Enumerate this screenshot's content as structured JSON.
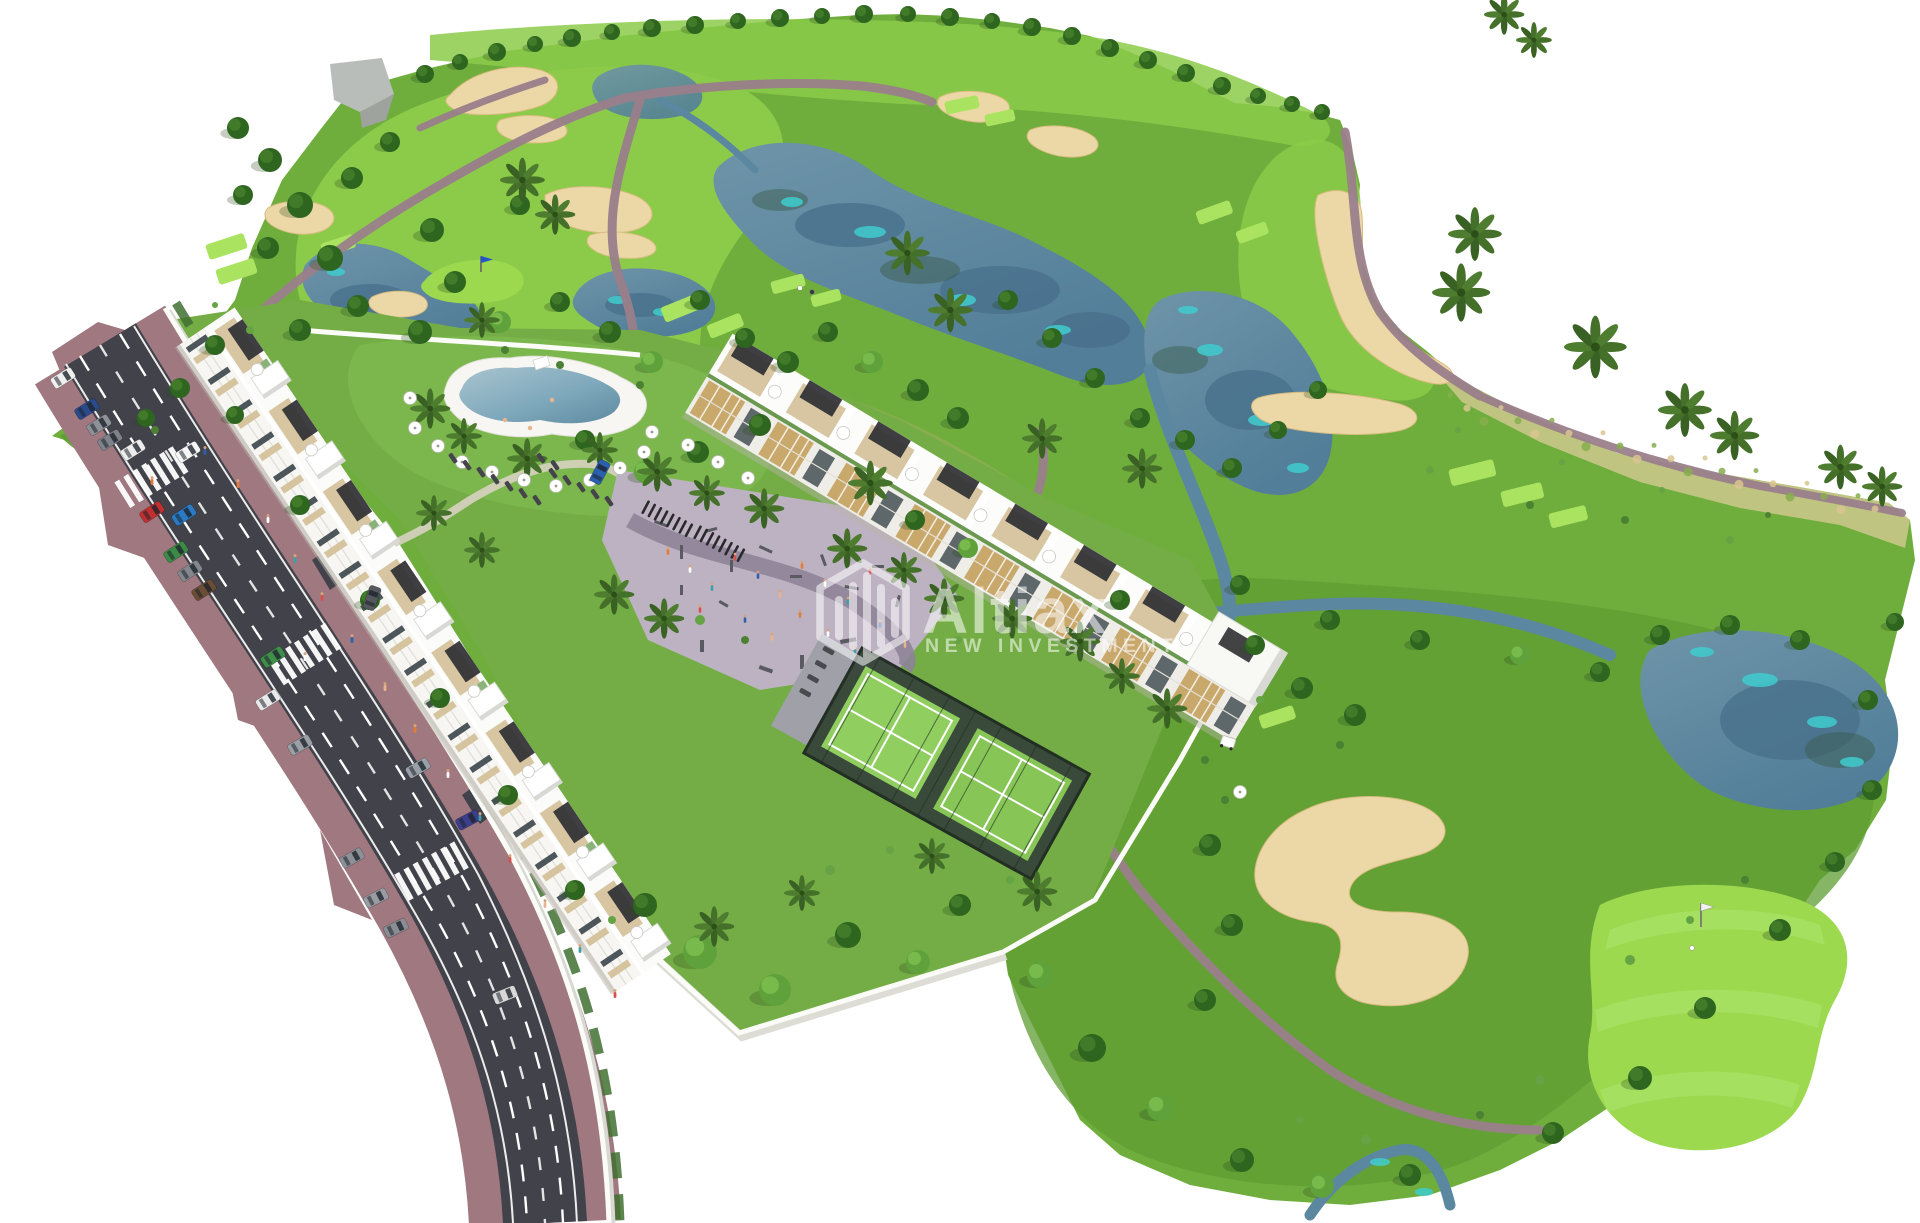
{
  "watermark": {
    "brand": "Altiax",
    "tagline": "NEW INVESTMENT",
    "logo_icon": "hexagon-bar-chart-icon",
    "color": "#FFFFFF",
    "opacity": 0.55
  },
  "scene": {
    "type": "aerial-architectural-rendering",
    "features": [
      "golf-course",
      "lakes",
      "sand-bunkers",
      "cart-paths",
      "tee-boxes",
      "putting-green-with-flag",
      "golf-cart",
      "access-road",
      "parked-cars",
      "apartment-block-a",
      "apartment-block-b",
      "swimming-pool",
      "playground-plaza",
      "padel-court",
      "gardens",
      "perimeter-walls",
      "palm-trees"
    ]
  },
  "palette": {
    "background": "#FFFFFF",
    "golf_base": "#6FAE3D",
    "fairway_light": "#8CCB49",
    "rough_dark": "#5F9C33",
    "tee_bright": "#A9E35F",
    "green_putting": "#9CD94F",
    "dry_scrub": "#C8C687",
    "dry_meadow": "#9FAF5C",
    "water": "#5C87A1",
    "water_deep": "#49708C",
    "water_teal": "#3FCCCE",
    "sand": "#ECD8A6",
    "path": "#9A7F8B",
    "asphalt": "#42424A",
    "sidewalk": "#A07880",
    "lane_marking": "#FFFFFF",
    "wall_white": "#FBFBF8",
    "building_white": "#F7F6F3",
    "facade_shadow": "#E7E7E4",
    "terrace_tan": "#D8C6A2",
    "wood_accent": "#C9A86C",
    "pergola_dark": "#2F2F33",
    "plaza": "#BDB2C2",
    "plaza_band": "#8E8398",
    "padel_fence": "#37453A",
    "padel_court": "#8FCE5F",
    "pool_deck": "#F7F6F2",
    "pool_water": "#7FA9BC",
    "lawn": "#74AD45",
    "tree_dark": "#2E6620",
    "tree_highlight": "#447F2C",
    "tree_light": "#5FA23C",
    "palm": "#44702A",
    "hedge": "#3F7030"
  }
}
